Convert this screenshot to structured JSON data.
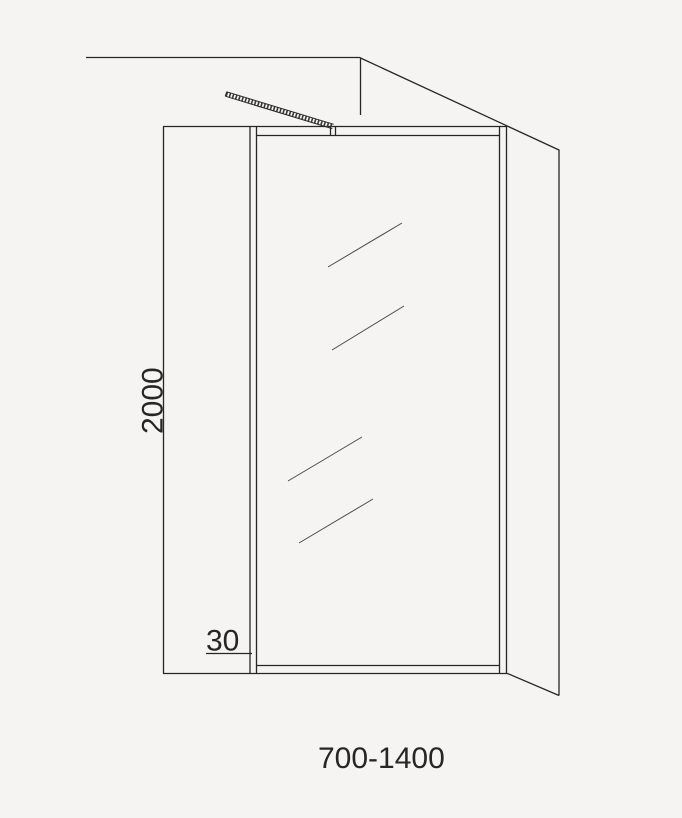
{
  "diagram": {
    "labels": {
      "height": "2000",
      "profile_width": "30",
      "width_range": "700-1400"
    },
    "colors": {
      "background": "#f5f4f2",
      "line": "#262626",
      "glass_line": "#4a4a4a"
    }
  }
}
